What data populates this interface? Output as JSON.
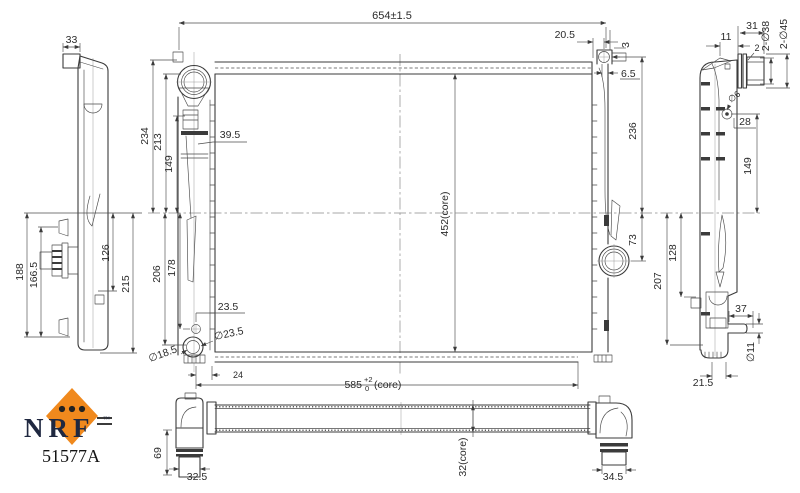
{
  "drawing_type": "radiator technical drawing",
  "colors": {
    "line": "#3b3b3b",
    "dim_text": "#2b2b2b",
    "logo_orange": "#F0891D",
    "logo_navy": "#1F2840",
    "background": "#ffffff"
  },
  "logo": {
    "brand": "NRF",
    "trademark": "™",
    "part_number": "51577A"
  },
  "left_view": {
    "tab_width": "33",
    "height_188": "188",
    "height_166_5": "166.5",
    "height_126": "126",
    "height_215": "215"
  },
  "front_view": {
    "overall_width": "654±1.5",
    "h234": "234",
    "h213": "213",
    "h149": "149",
    "bracket_39_5": "39.5",
    "h206": "206",
    "h178": "178",
    "core_height": "452(core)",
    "d20_5": "20.5",
    "d3": "3",
    "d6_5": "6.5",
    "h236": "236",
    "h73": "73",
    "drain_offset": "23.5",
    "drain_outer": "∅23.5",
    "drain_inner": "∅18.5",
    "w24": "24",
    "core_width_value": "585",
    "core_width_tol_upper": "+2",
    "core_width_tol_lower": "0",
    "core_width_suffix": "(core)"
  },
  "right_view": {
    "w11": "11",
    "w31": "31",
    "w2": "2",
    "pipes_38": "2-∅38",
    "pipes_45": "2-∅45",
    "bleed_screw": "∅6",
    "d28": "28",
    "h149": "149",
    "h128": "128",
    "h207": "207",
    "w37": "37",
    "pipe_dia": "∅11",
    "w21_5": "21.5"
  },
  "bottom_view": {
    "h69": "69",
    "w32_5": "32.5",
    "w34_5": "34.5",
    "core_depth": "32(core)"
  }
}
